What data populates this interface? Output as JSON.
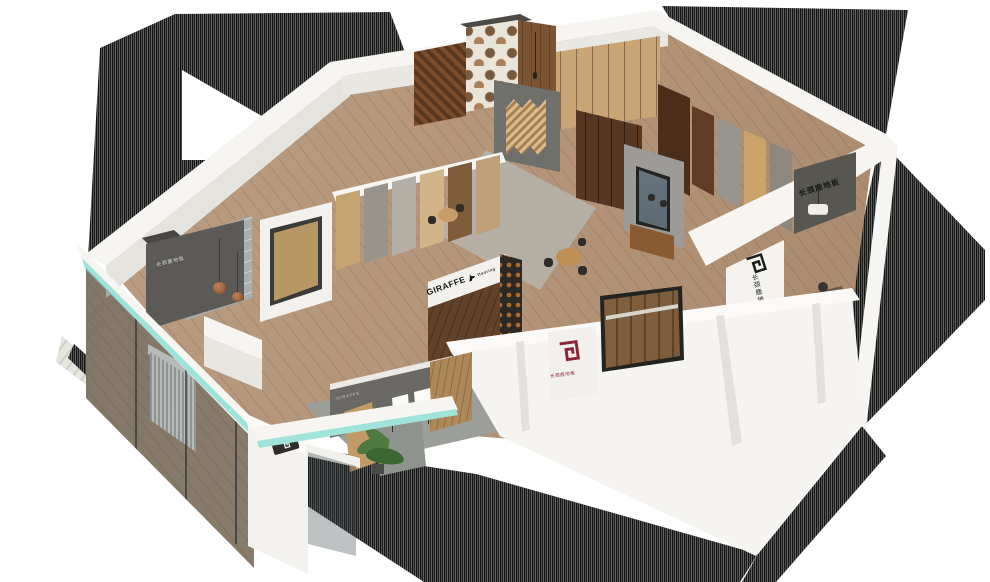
{
  "scene": {
    "type": "3d-isometric-showroom-render",
    "brand": "GIRAFFE"
  },
  "signs": {
    "giraffe_band": {
      "brand": "GIRAFFE",
      "sub": "flooring"
    },
    "logo_wall": {
      "vertical_text": "长颈鹿地板"
    },
    "office_wall": {
      "text": "长颈鹿地板"
    },
    "entry_wall": {
      "text": "长颈鹿地板"
    },
    "red_panel": {
      "caption": "长颈鹿地板"
    },
    "alcove_plaque": {
      "text": "GIRAFFE"
    }
  },
  "palette": {
    "glass_teal": "#9fe3da",
    "wall_white": "#f6f5f2",
    "wall_face_gray": "#e4e3de",
    "dark_feature_wall": "#5b5a56",
    "walnut": "#63422a",
    "oak": "#c6a472",
    "floor_wood": "#b2967a",
    "brand_red": "#8e2438",
    "logo_black": "#1e1e1e",
    "shadow_stripe": "#2a2a2a",
    "plant_green": "#4e7a42"
  }
}
